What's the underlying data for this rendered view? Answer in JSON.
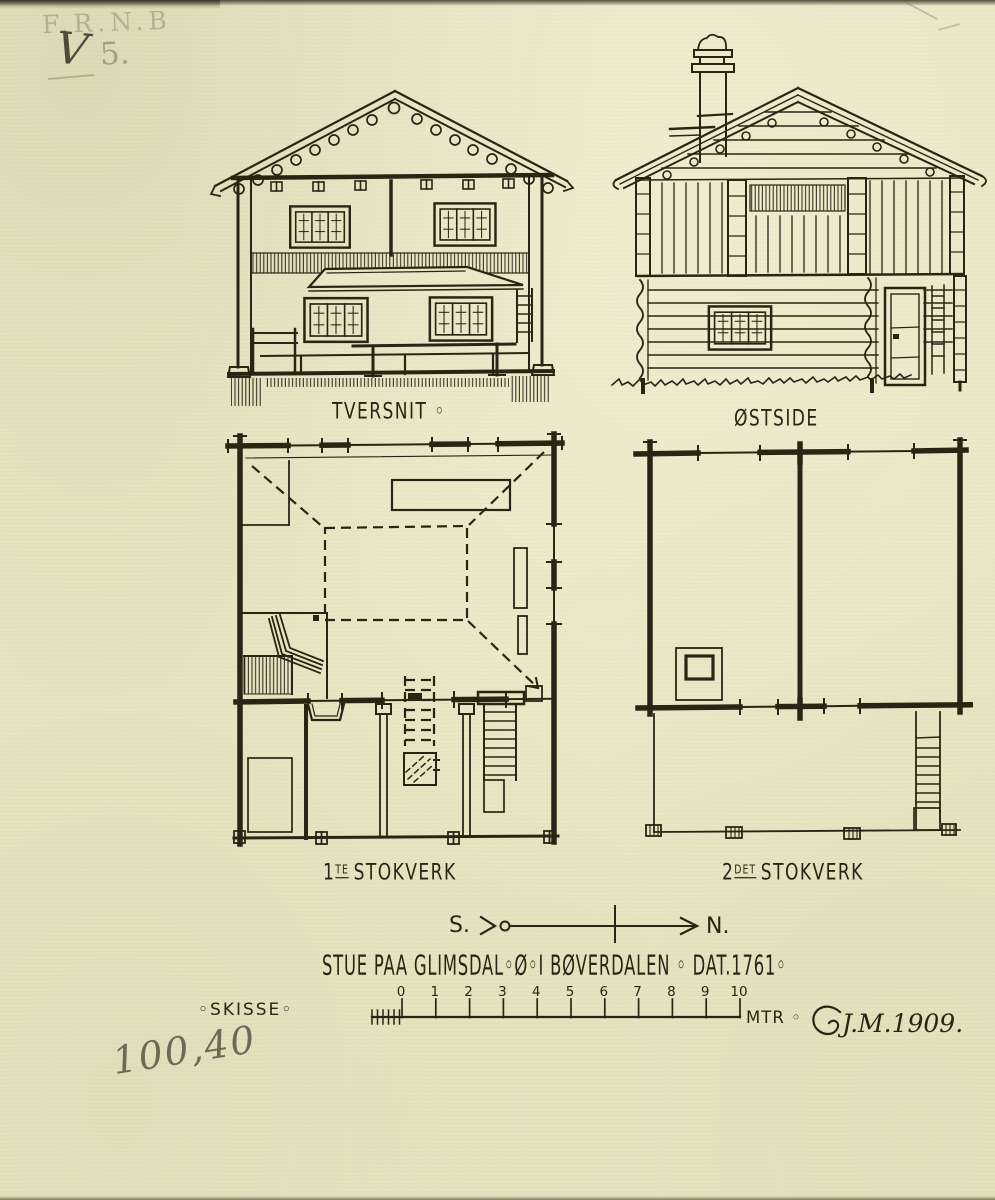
{
  "document": {
    "kind": "architectural sketch, scanned",
    "title": "STUE PAA GLIMSDAL◦Ø◦I BØVERDALEN ◦ DAT.1761◦",
    "subtitle": "◦SKISSE◦",
    "signature": "J.M.1909.",
    "colors": {
      "paper": "#eae7c4",
      "ink": "#2b2415",
      "pencil": "#857f68"
    }
  },
  "pencil_notes": {
    "faint_initials": "F.R.N.B",
    "check_mark": "V",
    "page_number": "5.",
    "archive_number": "100,40"
  },
  "views": {
    "tversnit": {
      "label": "TVERSNIT ◦"
    },
    "ostside": {
      "label": "ØSTSIDE"
    },
    "plan1": {
      "num": "1",
      "sup": "TE",
      "rest": "STOKVERK"
    },
    "plan2": {
      "num": "2",
      "sup": "DET",
      "rest": "STOKVERK"
    }
  },
  "compass": {
    "south": "S.",
    "north": "N."
  },
  "scale_bar": {
    "ticks": [
      "0",
      "1",
      "2",
      "3",
      "4",
      "5",
      "6",
      "7",
      "8",
      "9",
      "10"
    ],
    "unit": "MTR ◦"
  }
}
